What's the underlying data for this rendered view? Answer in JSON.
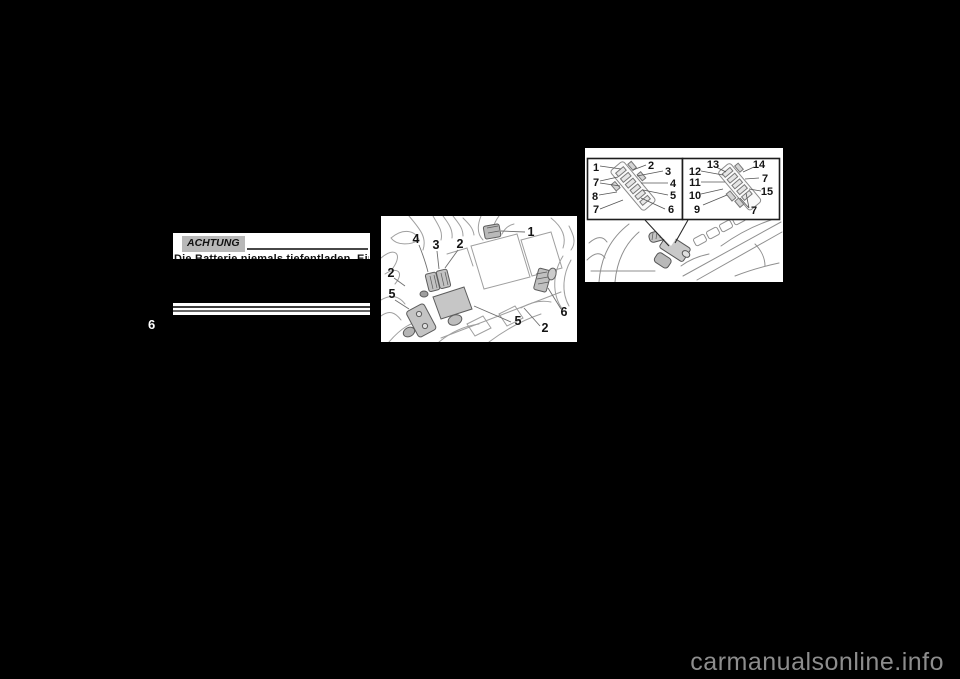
{
  "page": {
    "chapter_tab": "6",
    "watermark": "carmanualsonline.info"
  },
  "caution": {
    "label": "ACHTUNG",
    "clipped_line": "Die Batterie niemals tiefentladen. Ein"
  },
  "engine_diagram": {
    "callouts": [
      "4",
      "3",
      "2",
      "1",
      "2",
      "5",
      "5",
      "2",
      "6"
    ]
  },
  "fusebox_diagram": {
    "left_panel": {
      "callouts": [
        "1",
        "2",
        "3",
        "7",
        "4",
        "8",
        "5",
        "7",
        "6"
      ]
    },
    "right_panel": {
      "callouts": [
        "13",
        "14",
        "12",
        "7",
        "11",
        "15",
        "10",
        "9",
        "7"
      ]
    }
  }
}
